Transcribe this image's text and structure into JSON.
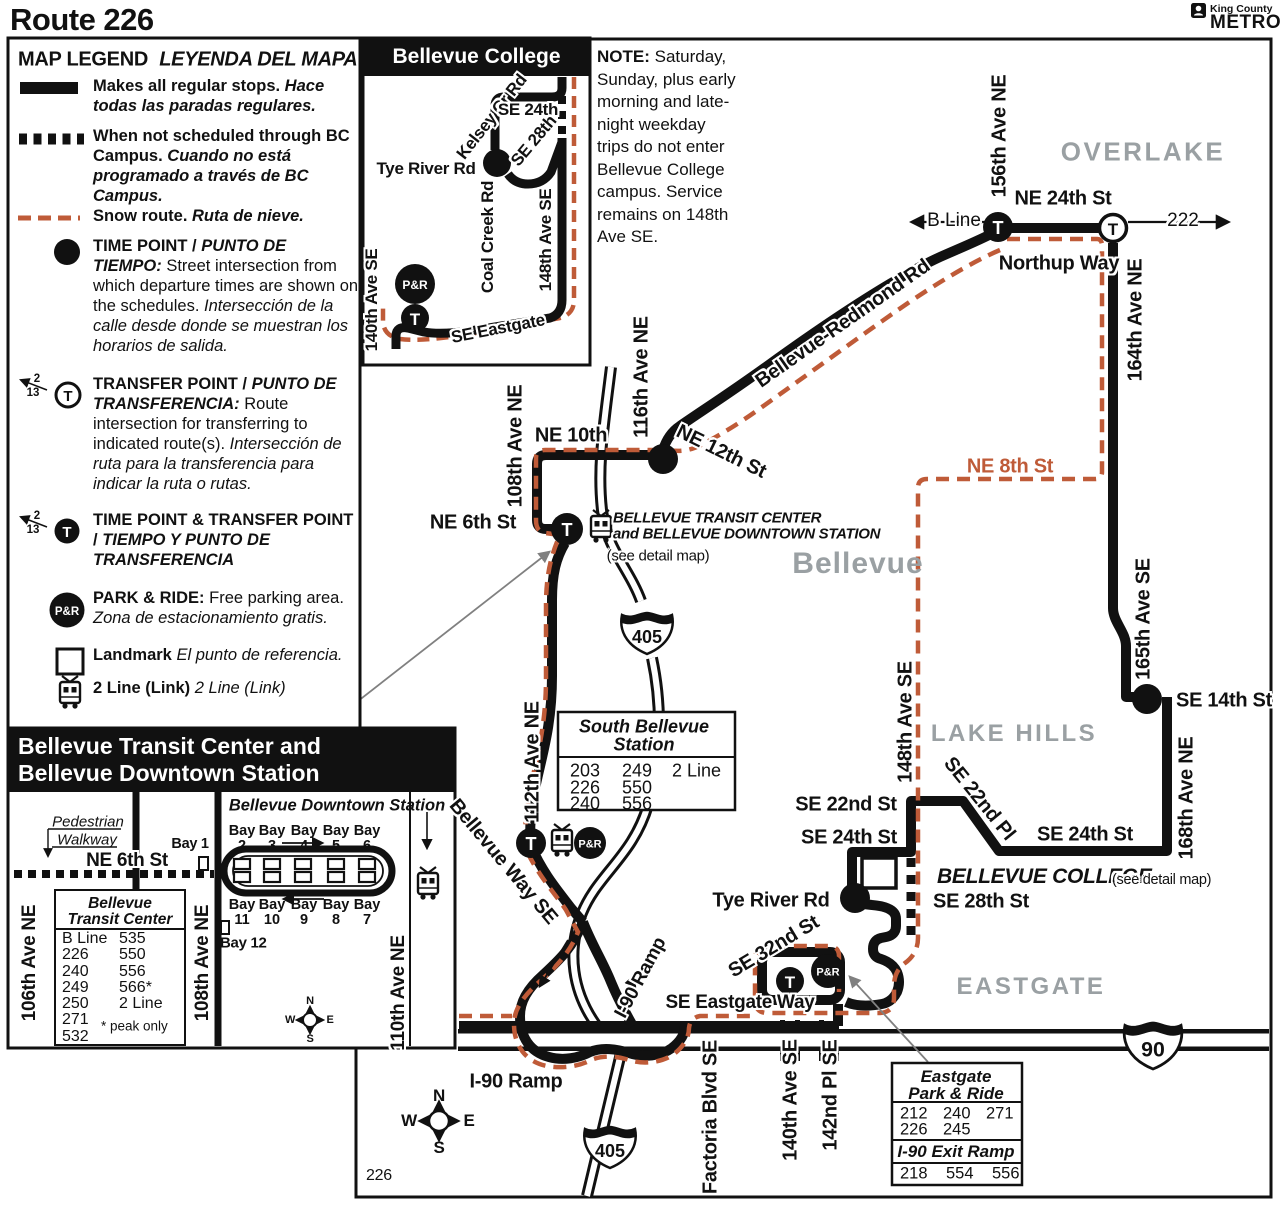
{
  "page": {
    "title": "Route 226",
    "sheet_number": "226"
  },
  "logo": {
    "county": "King County",
    "agency": "METRO"
  },
  "icons": {
    "transfer": "T",
    "park_ride": "P&R"
  },
  "shields": {
    "i405": "405",
    "i90": "90"
  },
  "compass": {
    "n": "N",
    "s": "S",
    "e": "E",
    "w": "W"
  },
  "legend": {
    "title": "MAP LEGEND",
    "title_es": "LEYENDA DEL MAPA",
    "sample_routes": [
      "2",
      "13"
    ],
    "regular_en": "Makes all regular stops.",
    "regular_es": "Hace todas las paradas regulares.",
    "bc_en": "When not scheduled through BC Campus.",
    "bc_es": "Cuando no está programado a través de BC Campus.",
    "snow_en": "Snow route.",
    "snow_es": "Ruta de nieve.",
    "tp_title": "TIME POINT /",
    "tp_title_es": "PUNTO DE TIEMPO:",
    "tp_body": "Street intersection from which departure times are shown on the schedules.",
    "tp_body_es": "Intersección de la calle desde donde se muestran los horarios de salida.",
    "tr_title": "TRANSFER POINT /",
    "tr_title_es": "PUNTO DE TRANSFERENCIA:",
    "tr_body": "Route intersection for transferring to indicated route(s).",
    "tr_body_es": "Intersección de ruta para la transferencia para indicar la ruta o rutas.",
    "tptr_title": "TIME POINT & TRANSFER POINT /",
    "tptr_title_es": "TIEMPO Y PUNTO DE TRANSFERENCIA",
    "pr_title": "PARK & RIDE:",
    "pr_body": "Free parking area.",
    "pr_body_es": "Zona de estacionamiento gratis.",
    "landmark_en": "Landmark",
    "landmark_es": "El punto de referencia.",
    "link_en": "2 Line (Link)",
    "link_es": "2 Line (Link)"
  },
  "note": {
    "label": "NOTE:",
    "text": "Saturday, Sunday, plus early morning and late-night weekday trips do not enter Bellevue College campus. Service remains on 148th Ave SE."
  },
  "bc_inset": {
    "title": "Bellevue College",
    "kelsey": "Kelsey Cr Rd",
    "se24th": "SE 24th",
    "se28th": "SE 28th",
    "tye": "Tye River Rd",
    "coal": "Coal Creek Rd",
    "ave148": "148th Ave SE",
    "ave140": "140th Ave SE",
    "eastgate": "SE Eastgate"
  },
  "map": {
    "overlake": "OVERLAKE",
    "ne24th": "NE 24th St",
    "bline": "B Line",
    "r222": "222",
    "ave156": "156th Ave NE",
    "northup": "Northup Way",
    "ave164": "164th Ave NE",
    "belred": "Bellevue-Redmond Rd",
    "ave116": "116th Ave NE",
    "ne10th": "NE 10th",
    "ne12th": "NE 12th St",
    "ave108": "108th Ave NE",
    "ne6th": "NE 6th St",
    "btc_line1": "BELLEVUE TRANSIT CENTER",
    "btc_line2": "and BELLEVUE DOWNTOWN STATION",
    "see_detail": "(see detail map)",
    "city": "Bellevue",
    "ne8th": "NE 8th St",
    "lakehills": "LAKE HILLS",
    "ave165": "165th Ave SE",
    "se14th": "SE 14th St",
    "ave168": "168th Ave NE",
    "ave148": "148th Ave SE",
    "se22nd_st": "SE 22nd St",
    "se22nd_pl": "SE 22nd Pl",
    "se24th_w": "SE 24th St",
    "se24th_e": "SE 24th St",
    "bc": "BELLEVUE COLLEGE",
    "bc_see": "(see detail map)",
    "se28th": "SE 28th St",
    "tye": "Tye River Rd",
    "se32nd": "SE 32nd St",
    "eastgate_way": "SE Eastgate Way",
    "eastgate": "EASTGATE",
    "i90ramp_diag": "I-90 Ramp",
    "i90ramp_h": "I-90 Ramp",
    "factoria": "Factoria Blvd SE",
    "ave140": "140th Ave SE",
    "pl142": "142nd Pl SE",
    "ave112": "112th Ave NE",
    "bellevue_way": "Bellevue Way SE"
  },
  "btc": {
    "header1": "Bellevue Transit Center and",
    "header2": "Bellevue Downtown Station",
    "ped1": "Pedestrian",
    "ped2": "Walkway",
    "bay1": "Bay 1",
    "ne6th": "NE 6th St",
    "station_title": "Bellevue Downtown Station",
    "bay_word": "Bay",
    "bays_top": [
      "2",
      "3",
      "4",
      "5",
      "6"
    ],
    "bays_bottom": [
      "11",
      "10",
      "9",
      "8",
      "7"
    ],
    "bay12": "Bay 12",
    "ave106": "106th Ave NE",
    "ave108": "108th Ave NE",
    "ave110": "110th Ave NE",
    "box_title1": "Bellevue",
    "box_title2": "Transit Center",
    "col1": [
      "B Line",
      "226",
      "240",
      "249",
      "250",
      "271",
      "532"
    ],
    "col2": [
      "535",
      "550",
      "556",
      "566*",
      "2 Line"
    ],
    "note": "* peak only"
  },
  "south_bellevue": {
    "title1": "South Bellevue",
    "title2": "Station",
    "rows": [
      [
        "203",
        "249",
        "2 Line"
      ],
      [
        "226",
        "550",
        ""
      ],
      [
        "240",
        "556",
        ""
      ]
    ]
  },
  "eastgate_pr": {
    "title1": "Eastgate",
    "title2": "Park & Ride",
    "row1": [
      "212",
      "240",
      "271"
    ],
    "row2": [
      "226",
      "245"
    ],
    "sub": "I-90 Exit Ramp",
    "row3": [
      "218",
      "554",
      "556"
    ]
  },
  "colors": {
    "snow": "#bf5b38",
    "gray_label": "#9aa0a3",
    "black": "#111111"
  }
}
